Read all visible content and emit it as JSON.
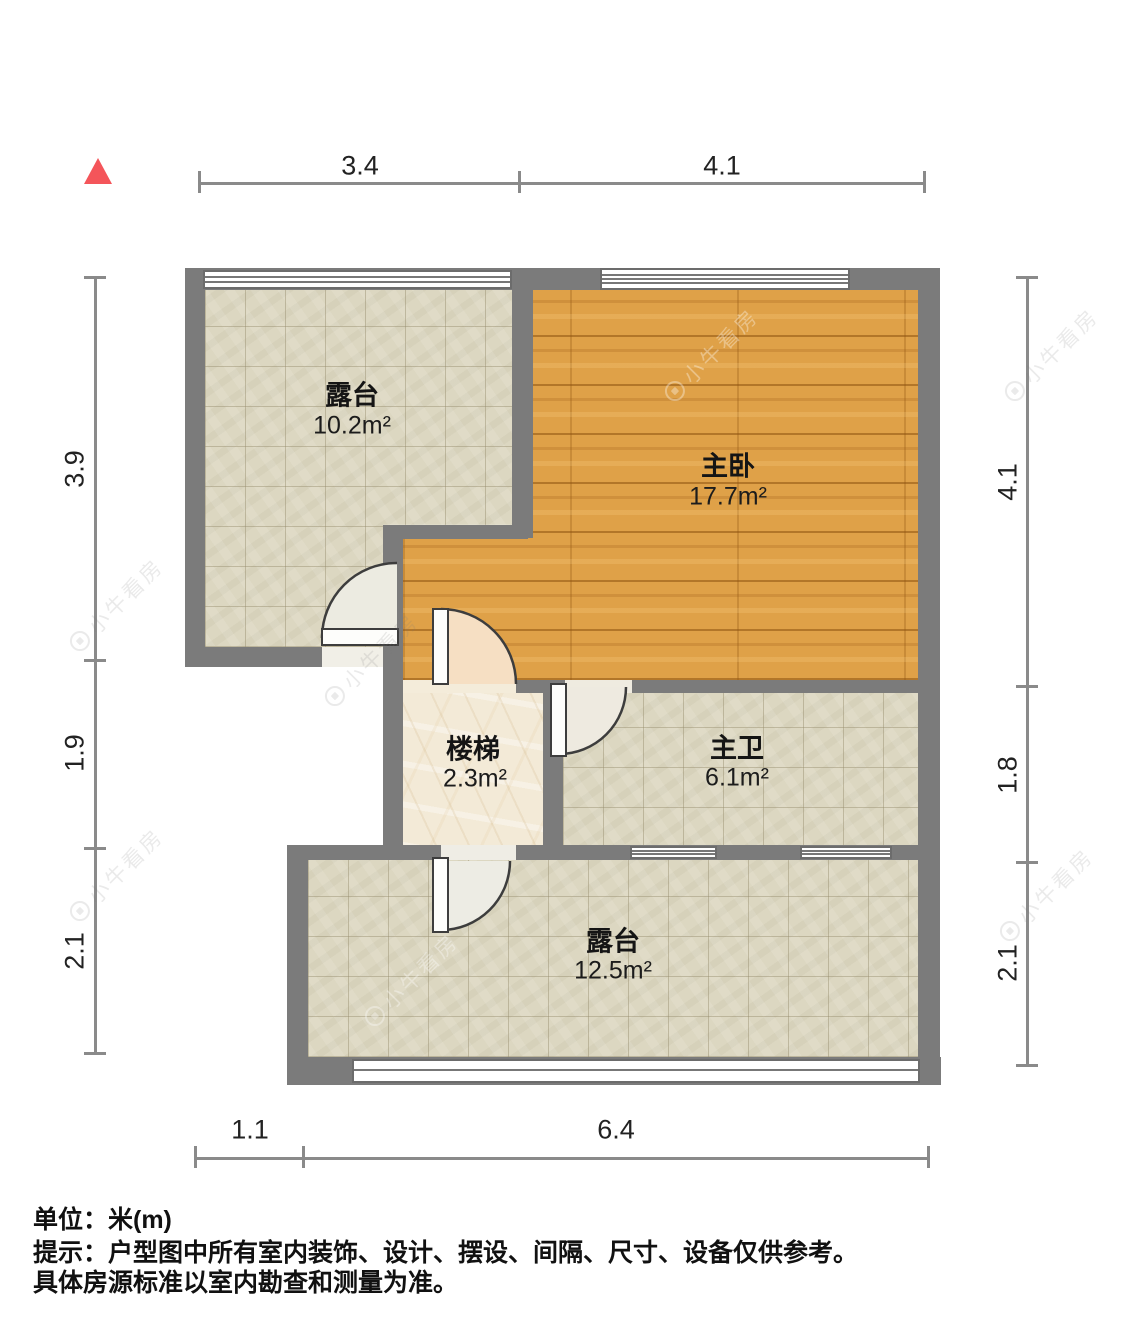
{
  "plan": {
    "rooms": [
      {
        "id": "terrace-top",
        "name": "露台",
        "area": "10.2m²"
      },
      {
        "id": "master-bedroom",
        "name": "主卧",
        "area": "17.7m²"
      },
      {
        "id": "stairs",
        "name": "楼梯",
        "area": "2.3m²"
      },
      {
        "id": "master-bath",
        "name": "主卫",
        "area": "6.1m²"
      },
      {
        "id": "terrace-bottom",
        "name": "露台",
        "area": "12.5m²"
      }
    ],
    "dimensions": {
      "top": [
        "3.4",
        "4.1"
      ],
      "bottom": [
        "1.1",
        "6.4"
      ],
      "left": [
        "3.9",
        "1.9",
        "2.1"
      ],
      "right": [
        "4.1",
        "1.8",
        "2.1"
      ]
    },
    "north_marker": "north-triangle",
    "watermark": "小牛看房",
    "colors": {
      "wall": "#7b7b7b",
      "wood_floor": "#dfa148",
      "tile_floor": "#dcd7c1",
      "marble_floor": "#f3ead7",
      "door_swing_peach": "#f6dfc3",
      "north_red": "#f4555a"
    }
  },
  "footer": {
    "unit_line": "单位：米(m)",
    "tip_line1": "提示：户型图中所有室内装饰、设计、摆设、间隔、尺寸、设备仅供参考。",
    "tip_line2": "具体房源标准以室内勘查和测量为准。"
  }
}
